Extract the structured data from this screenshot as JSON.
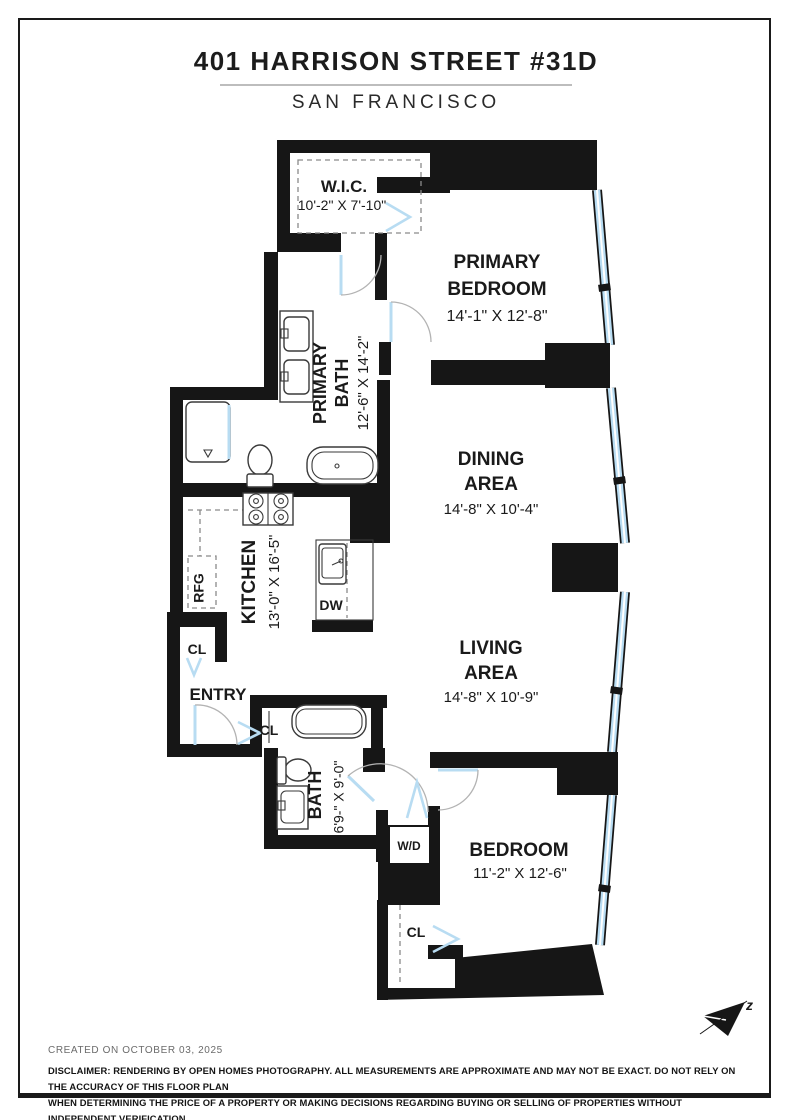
{
  "page": {
    "title": "401 HARRISON STREET #31D",
    "subtitle": "SAN FRANCISCO"
  },
  "rooms": {
    "wic": {
      "name": "W.I.C.",
      "dims": "10'-2\" X 7'-10\""
    },
    "primary_bedroom": {
      "line1": "PRIMARY",
      "line2": "BEDROOM",
      "dims": "14'-1\" X 12'-8\""
    },
    "primary_bath": {
      "line1": "PRIMARY",
      "line2": "BATH",
      "dims": "12'-6\" X 14'-2\""
    },
    "dining_area": {
      "line1": "DINING",
      "line2": "AREA",
      "dims": "14'-8\" X 10'-4\""
    },
    "living_area": {
      "line1": "LIVING",
      "line2": "AREA",
      "dims": "14'-8\" X 10'-9\""
    },
    "kitchen": {
      "name": "KITCHEN",
      "dims": "13'-0\" X 16'-5\""
    },
    "bath": {
      "name": "BATH",
      "dims": "6'9-\" X 9'-0\""
    },
    "bedroom": {
      "name": "BEDROOM",
      "dims": "11'-2\" X 12'-6\""
    },
    "entry": {
      "name": "ENTRY"
    }
  },
  "labels": {
    "refrigerator": "RFG",
    "dishwasher": "DW",
    "washer_dryer": "W/D",
    "closet_entry_upper": "CL",
    "closet_entry_lower": "CL",
    "closet_bedroom": "CL"
  },
  "compass": {
    "north_label": "z"
  },
  "footer": {
    "created": "CREATED ON OCTOBER 03, 2025",
    "disclaimer_line1": "DISCLAIMER: RENDERING BY OPEN HOMES PHOTOGRAPHY. ALL MEASUREMENTS ARE APPROXIMATE AND MAY NOT BE EXACT. DO NOT RELY ON THE ACCURACY OF THIS FLOOR PLAN",
    "disclaimer_line2": "WHEN DETERMINING THE PRICE OF A PROPERTY OR MAKING DECISIONS REGARDING BUYING OR SELLING OF PROPERTIES WITHOUT INDEPENDENT VERIFICATION."
  },
  "colors": {
    "wall": "#161616",
    "window_glass": "#b8dcf2",
    "door_leaf": "#b8dcf2",
    "arc": "#b3b3b3",
    "text": "#1a1a1a",
    "muted_text": "#6b6b6b"
  }
}
